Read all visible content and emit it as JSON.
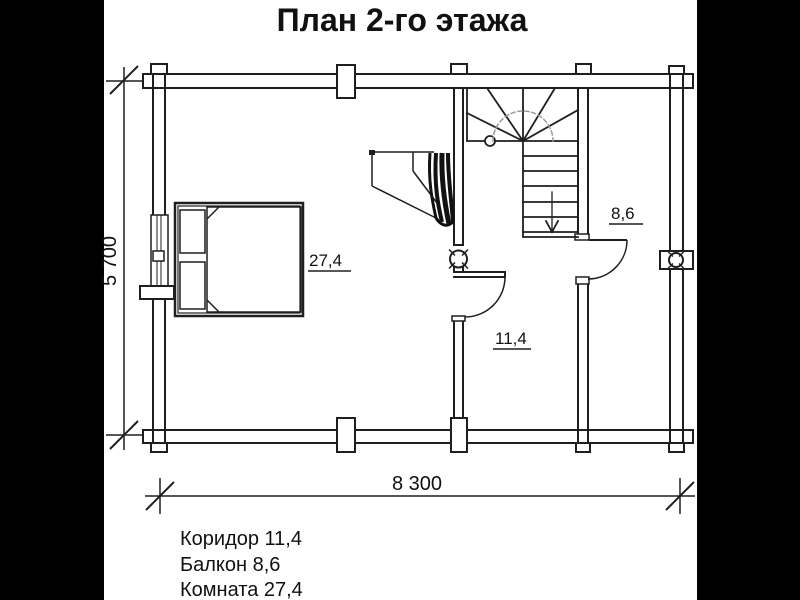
{
  "title": "План 2-го этажа",
  "plan": {
    "rooms": {
      "room": {
        "name": "Комната",
        "area": "27,4"
      },
      "balcony": {
        "name": "Балкон",
        "area": "8,6"
      },
      "corridor": {
        "name": "Коридор",
        "area": "11,4"
      }
    },
    "dimensions": {
      "width": "8 300",
      "height": "5 700"
    }
  },
  "legend": {
    "items": [
      {
        "label": "Коридор 11,4"
      },
      {
        "label": "Балкон 8,6"
      },
      {
        "label": "Комната 27,4"
      }
    ]
  },
  "colors": {
    "line": "#1f1f1f",
    "background": "#ffffff",
    "pillarbox": "#000000",
    "walkline": "#999999"
  }
}
